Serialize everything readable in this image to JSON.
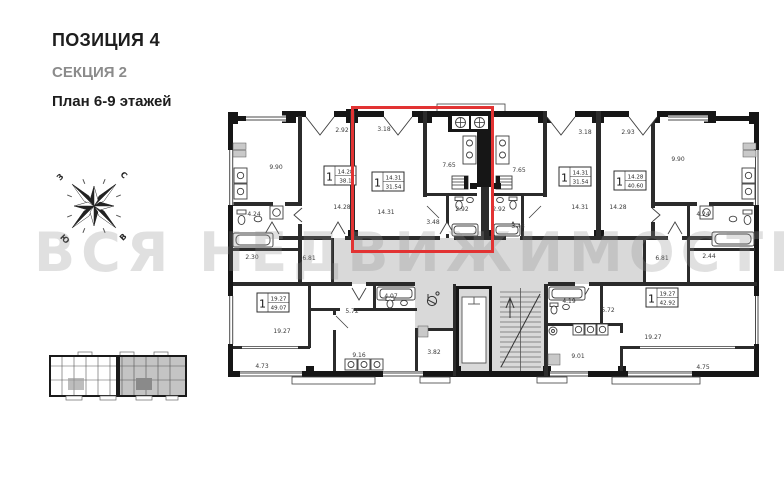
{
  "header": {
    "position": "ПОЗИЦИЯ 4",
    "section": "СЕКЦИЯ 2",
    "floors": "План 6-9 этажей"
  },
  "compass": {
    "north": "С",
    "east": "В",
    "south": "Ю",
    "west": "З"
  },
  "watermark": "ВСЯ НЕДВИЖИМОСТЬ",
  "colors": {
    "highlight_red": "#e23333",
    "corridor_gray": "#d9d9d9",
    "wall_black": "#161616",
    "key_plan_gray": "#c4c4c4"
  },
  "plan": {
    "apartments": [
      {
        "rooms": "1",
        "living_area": "14.28",
        "total_area": "38.1"
      },
      {
        "rooms": "1",
        "living_area": "14.31",
        "total_area": "31.54"
      },
      {
        "rooms": "1",
        "living_area": "14.31",
        "total_area": "31.54"
      },
      {
        "rooms": "1",
        "living_area": "14.28",
        "total_area": "40.60"
      },
      {
        "rooms": "1",
        "living_area": "19.27",
        "total_area": "49.07"
      },
      {
        "rooms": "1",
        "living_area": "19.27",
        "total_area": "42.92"
      }
    ],
    "room_labels": [
      "2.92",
      "3.18",
      "9.90",
      "14.28",
      "14.31",
      "7.65",
      "2.92",
      "3.48",
      "7.65",
      "2.92",
      "3.48",
      "3.18",
      "14.31",
      "2.93",
      "14.28",
      "9.90",
      "4.24",
      "4.24",
      "2.30",
      "6.81",
      "6.81",
      "2.44",
      "4.07",
      "5.72",
      "19.27",
      "4.73",
      "9.16",
      "3.82",
      "4.19",
      "5.72",
      "9.01",
      "19.27",
      "4.75"
    ]
  }
}
